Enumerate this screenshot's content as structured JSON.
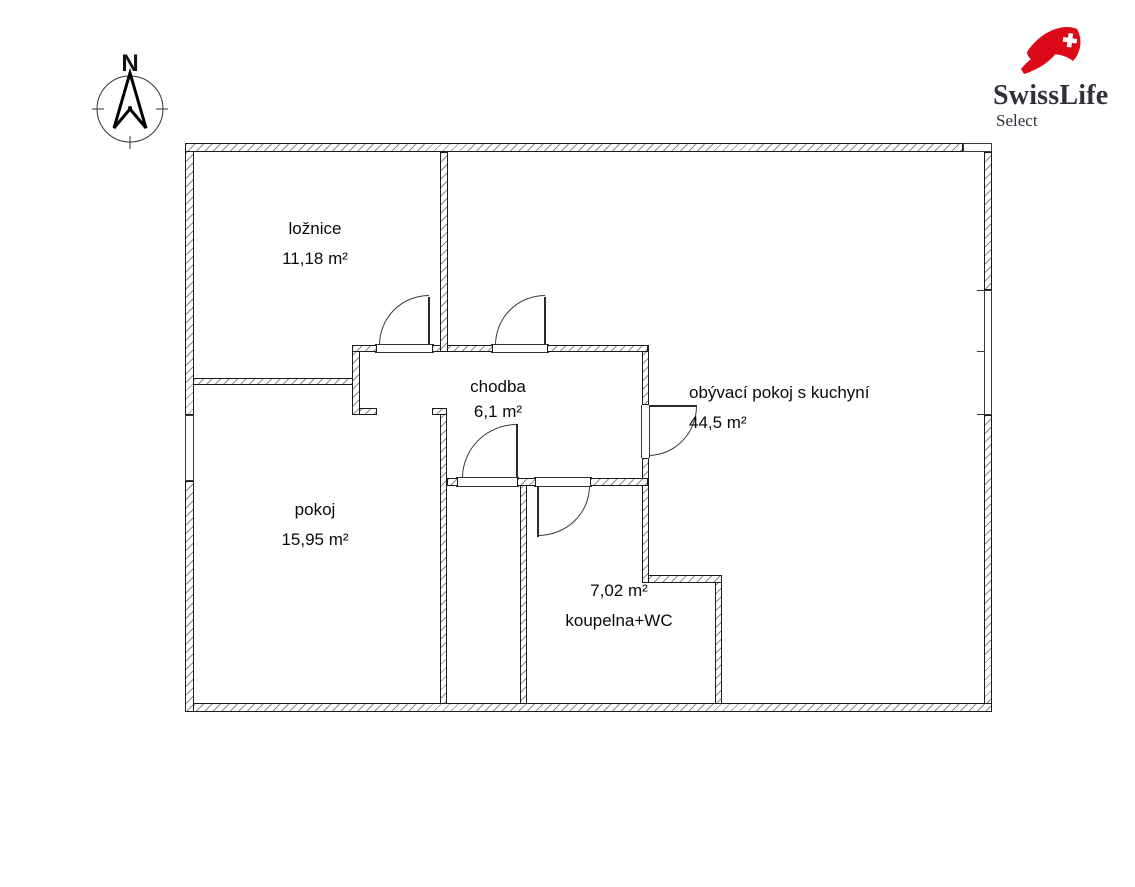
{
  "compass": {
    "north": "N"
  },
  "logo": {
    "brand": "SwissLife",
    "subbrand": "Select",
    "accent_red": "#dc0a18",
    "text_color": "#30303a"
  },
  "rooms": [
    {
      "name": "ložnice",
      "area": "11,18 m²"
    },
    {
      "name": "chodba",
      "area": "6,1 m²"
    },
    {
      "name": "obývací pokoj s kuchyní",
      "area": "44,5 m²"
    },
    {
      "name": "pokoj",
      "area": "15,95 m²"
    },
    {
      "name": "koupelna+WC",
      "area": "7,02 m²"
    }
  ]
}
